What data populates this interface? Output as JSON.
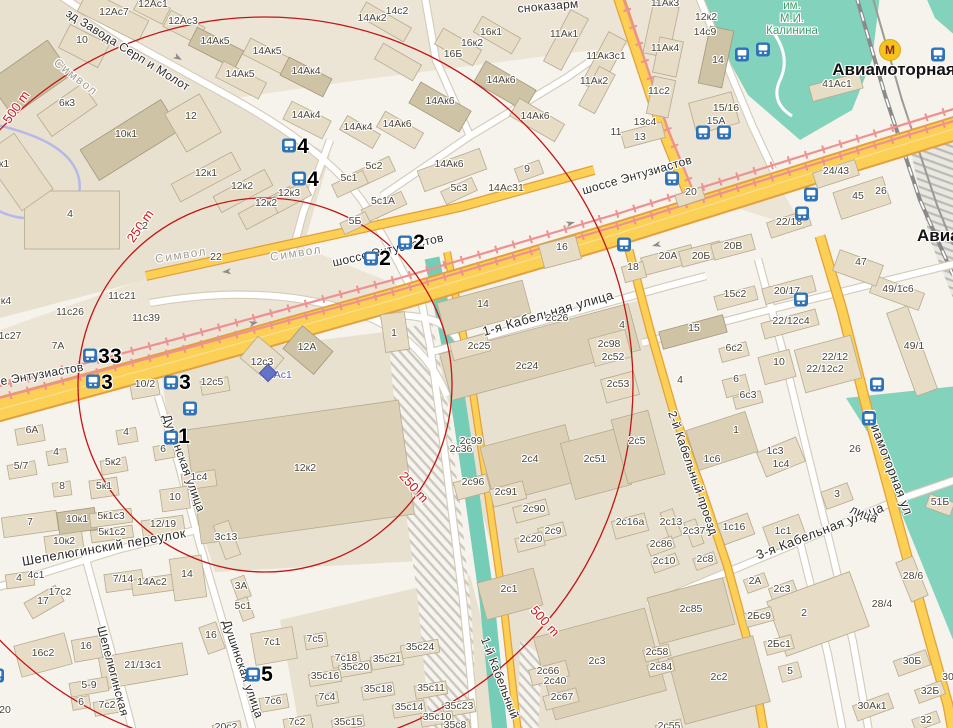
{
  "map": {
    "colors": {
      "ring": "#c41414",
      "road_major": "#fccf55",
      "tram": "#ee9191",
      "water": "#76cdb7",
      "park": "#82d2bc",
      "bus_icon": "#2e72b8",
      "metro_icon_bg": "#f5c31d",
      "street_label": "#2e2c28",
      "building_label": "#4a4539"
    },
    "rings": {
      "labels": [
        "250 m",
        "500 m"
      ]
    },
    "stations": [
      "Авиамоторная"
    ],
    "park_name": "им. М.И. Калинина",
    "labels": [
      [
        "зд Завода Серп и Молот",
        128,
        50,
        32,
        "s"
      ],
      [
        "Символ",
        76,
        77,
        38,
        "sg"
      ],
      [
        "Символ",
        181,
        255,
        -9,
        "sg"
      ],
      [
        "Символ",
        296,
        253,
        -9,
        "sg"
      ],
      [
        "сноказарм",
        548,
        6,
        -5,
        "s"
      ],
      [
        "е Энтузиастов",
        42,
        374,
        -10,
        "s"
      ],
      [
        "шоссе Энтузиастов",
        388,
        250,
        -13,
        "s"
      ],
      [
        "шоссе Энтузиастов",
        637,
        175,
        -16,
        "s"
      ],
      [
        "1-я Кабельная улица",
        548,
        313,
        -16,
        "s2"
      ],
      [
        "Шепелюгинский переулок",
        104,
        547,
        -10,
        "s2"
      ],
      [
        "Шепелюгинская",
        113,
        671,
        75,
        "s"
      ],
      [
        "Душинская улица",
        184,
        463,
        70,
        "s"
      ],
      [
        "Душинская улица",
        243,
        669,
        71,
        "s"
      ],
      [
        "1-й Кабельный",
        500,
        678,
        69,
        "s"
      ],
      [
        "2-й Кабельный проезд",
        693,
        473,
        71,
        "s"
      ],
      [
        "3-я Кабельная улица",
        820,
        531,
        -21,
        "s2"
      ],
      [
        "Авиамоторная ул",
        889,
        462,
        69,
        "s2"
      ],
      [
        "лица",
        864,
        514,
        22,
        "s"
      ],
      [
        "Авиамоторная",
        894,
        70,
        0,
        "st"
      ],
      [
        "Авиамоторная",
        917,
        236,
        0,
        "st",
        "l"
      ],
      [
        "им.\nМ.И.\nКалинина",
        792,
        19,
        0,
        "p"
      ],
      [
        "500 m",
        16,
        107,
        -55,
        "d"
      ],
      [
        "250 m",
        140,
        226,
        -55,
        "d"
      ],
      [
        "250 m",
        414,
        487,
        48,
        "d"
      ],
      [
        "500 m",
        545,
        621,
        48,
        "d"
      ],
      [
        "4",
        303,
        147,
        0,
        "n"
      ],
      [
        "4",
        313,
        180,
        0,
        "n"
      ],
      [
        "2",
        419,
        243,
        0,
        "n"
      ],
      [
        "2",
        385,
        259,
        0,
        "n"
      ],
      [
        "3",
        104,
        357,
        0,
        "n"
      ],
      [
        "3",
        116,
        357,
        0,
        "n"
      ],
      [
        "3",
        107,
        383,
        0,
        "n"
      ],
      [
        "3",
        185,
        383,
        0,
        "n"
      ],
      [
        "1",
        184,
        437,
        0,
        "n"
      ],
      [
        "5",
        267,
        675,
        0,
        "n"
      ],
      [
        "12Ас1",
        277,
        375,
        0,
        "bb"
      ],
      [
        "12Ас1",
        153,
        4
      ],
      [
        "12Ас7",
        114,
        12
      ],
      [
        "12Ас3",
        183,
        21
      ],
      [
        "10",
        82,
        40
      ],
      [
        "14Ак5",
        215,
        41
      ],
      [
        "14Ак5",
        267,
        51
      ],
      [
        "14Ак5",
        240,
        74
      ],
      [
        "14Ак4",
        306,
        71
      ],
      [
        "14Ак4",
        306,
        115
      ],
      [
        "14с2",
        397,
        11
      ],
      [
        "14Ак2",
        372,
        18
      ],
      [
        "16к1",
        491,
        32
      ],
      [
        "16к2",
        472,
        43
      ],
      [
        "16Б",
        453,
        54
      ],
      [
        "6к3",
        67,
        103
      ],
      [
        "12",
        191,
        116
      ],
      [
        "10к1",
        126,
        134
      ],
      [
        "14Ак6",
        501,
        80
      ],
      [
        "14Ак6",
        440,
        101
      ],
      [
        "14Ак6",
        397,
        124
      ],
      [
        "14Ак4",
        358,
        127
      ],
      [
        "14Ак6",
        535,
        116
      ],
      [
        "14Ак6",
        449,
        164
      ],
      [
        "12к1",
        206,
        173
      ],
      [
        "12к2",
        242,
        186
      ],
      [
        "12к3",
        289,
        193
      ],
      [
        "12к2",
        266,
        203
      ],
      [
        "4",
        70,
        214
      ],
      [
        "2",
        145,
        226
      ],
      [
        "к1",
        4,
        164
      ],
      [
        "22",
        216,
        257
      ],
      [
        "11с21",
        122,
        296
      ],
      [
        "11с26",
        70,
        312
      ],
      [
        "11с39",
        146,
        318
      ],
      [
        "1с27",
        10,
        336
      ],
      [
        "к4",
        6,
        301
      ],
      [
        "7А",
        58,
        346
      ],
      [
        "5с2",
        374,
        166
      ],
      [
        "5с1",
        349,
        178
      ],
      [
        "5с1А",
        383,
        201
      ],
      [
        "5Б",
        355,
        221
      ],
      [
        "5с3",
        459,
        188
      ],
      [
        "14Ас31",
        506,
        188
      ],
      [
        "9",
        527,
        169
      ],
      [
        "11Ак1",
        564,
        34
      ],
      [
        "11Ак3с1",
        606,
        56
      ],
      [
        "11Ак2",
        594,
        81
      ],
      [
        "11Ак3",
        665,
        3
      ],
      [
        "12к2",
        706,
        17
      ],
      [
        "14с9",
        705,
        32
      ],
      [
        "11Ак4",
        665,
        48
      ],
      [
        "14",
        718,
        60
      ],
      [
        "11с2",
        659,
        91
      ],
      [
        "13с4",
        645,
        122
      ],
      [
        "11",
        616,
        132
      ],
      [
        "13",
        640,
        137
      ],
      [
        "15/16",
        726,
        108
      ],
      [
        "15А",
        716,
        121
      ],
      [
        "41Ас1",
        837,
        84
      ],
      [
        "24/43",
        836,
        171
      ],
      [
        "45",
        858,
        196
      ],
      [
        "26",
        881,
        191
      ],
      [
        "47",
        861,
        262
      ],
      [
        "20",
        691,
        192
      ],
      [
        "22/18",
        789,
        222
      ],
      [
        "49/1с6",
        898,
        289
      ],
      [
        "49/1",
        914,
        346
      ],
      [
        "16",
        562,
        247
      ],
      [
        "18",
        633,
        267
      ],
      [
        "20А",
        668,
        256
      ],
      [
        "20Б",
        701,
        256
      ],
      [
        "20В",
        733,
        246
      ],
      [
        "15с2",
        735,
        294
      ],
      [
        "20/17",
        787,
        291
      ],
      [
        "22/12с4",
        791,
        321
      ],
      [
        "15",
        694,
        328
      ],
      [
        "6с2",
        734,
        348
      ],
      [
        "10",
        779,
        362
      ],
      [
        "22/12",
        835,
        357
      ],
      [
        "22/12с2",
        825,
        369
      ],
      [
        "4",
        680,
        380
      ],
      [
        "6",
        736,
        379
      ],
      [
        "6с3",
        748,
        395
      ],
      [
        "1",
        736,
        430
      ],
      [
        "5",
        641,
        441
      ],
      [
        "1с6",
        712,
        459
      ],
      [
        "1с3",
        775,
        451
      ],
      [
        "1с4",
        781,
        464
      ],
      [
        "26",
        855,
        449
      ],
      [
        "2с26",
        557,
        318
      ],
      [
        "14",
        483,
        304
      ],
      [
        "2с25",
        479,
        346
      ],
      [
        "2с24",
        527,
        366
      ],
      [
        "2с98",
        609,
        344
      ],
      [
        "2с52",
        613,
        357
      ],
      [
        "2с53",
        618,
        384
      ],
      [
        "4",
        622,
        325
      ],
      [
        "1",
        394,
        333
      ],
      [
        "12А",
        307,
        347
      ],
      [
        "12с3",
        262,
        362
      ],
      [
        "12с5",
        212,
        382
      ],
      [
        "10/2",
        145,
        384
      ],
      [
        "12к2",
        305,
        468
      ],
      [
        "1с4",
        199,
        477
      ],
      [
        "6А",
        32,
        430
      ],
      [
        "4",
        56,
        452
      ],
      [
        "5/7",
        21,
        466
      ],
      [
        "5к2",
        113,
        462
      ],
      [
        "4",
        126,
        432
      ],
      [
        "6",
        163,
        449
      ],
      [
        "2с99",
        471,
        441
      ],
      [
        "2с36",
        461,
        449
      ],
      [
        "2с4",
        530,
        459
      ],
      [
        "2с51",
        595,
        459
      ],
      [
        "2с5",
        637,
        441
      ],
      [
        "2с96",
        473,
        482
      ],
      [
        "2с91",
        506,
        492
      ],
      [
        "2с90",
        534,
        509
      ],
      [
        "2с9",
        553,
        531
      ],
      [
        "2с20",
        531,
        539
      ],
      [
        "2с16а",
        630,
        522
      ],
      [
        "2с1",
        509,
        589
      ],
      [
        "8",
        62,
        486
      ],
      [
        "5к1",
        104,
        486
      ],
      [
        "10",
        175,
        497
      ],
      [
        "7",
        30,
        522
      ],
      [
        "10к1",
        77,
        519
      ],
      [
        "5к1с3",
        111,
        516
      ],
      [
        "12/19",
        163,
        524
      ],
      [
        "10к2",
        64,
        541
      ],
      [
        "5к1с2",
        112,
        532
      ],
      [
        "3с13",
        226,
        537
      ],
      [
        "4",
        19,
        578
      ],
      [
        "4с1",
        36,
        575
      ],
      [
        "7/14",
        123,
        579
      ],
      [
        "14Ас2",
        152,
        582
      ],
      [
        "14",
        187,
        574
      ],
      [
        "17",
        43,
        601
      ],
      [
        "17с2",
        60,
        592
      ],
      [
        "3А",
        241,
        586
      ],
      [
        "5с1",
        243,
        606
      ],
      [
        "16",
        211,
        635
      ],
      [
        "16",
        86,
        646
      ],
      [
        "16с2",
        43,
        653
      ],
      [
        "7с1",
        272,
        642
      ],
      [
        "7с5",
        315,
        639
      ],
      [
        "21/13с1",
        143,
        665
      ],
      [
        "5-9",
        89,
        685
      ],
      [
        "6",
        81,
        702
      ],
      [
        "7с2",
        107,
        705
      ],
      [
        "20",
        5,
        710
      ],
      [
        "7с6",
        273,
        701
      ],
      [
        "7с2",
        297,
        722
      ],
      [
        "20с2",
        226,
        727
      ],
      [
        "35с24",
        420,
        647
      ],
      [
        "7с18",
        346,
        658
      ],
      [
        "35с21",
        387,
        659
      ],
      [
        "35с20",
        355,
        667
      ],
      [
        "35с16",
        325,
        676
      ],
      [
        "35с18",
        378,
        689
      ],
      [
        "35с11",
        431,
        688
      ],
      [
        "7с4",
        327,
        697
      ],
      [
        "35с14",
        409,
        707
      ],
      [
        "35с23",
        459,
        706
      ],
      [
        "35с15",
        348,
        722
      ],
      [
        "35с10",
        437,
        717
      ],
      [
        "35с8",
        455,
        725
      ],
      [
        "2с66",
        548,
        671
      ],
      [
        "2с40",
        555,
        681
      ],
      [
        "2с67",
        562,
        697
      ],
      [
        "2с3",
        597,
        661
      ],
      [
        "2с13",
        671,
        522
      ],
      [
        "2с37",
        694,
        531
      ],
      [
        "2с86",
        661,
        544
      ],
      [
        "2с10",
        664,
        561
      ],
      [
        "2с8",
        705,
        559
      ],
      [
        "1с16",
        734,
        527
      ],
      [
        "1с1",
        783,
        531
      ],
      [
        "3",
        837,
        494
      ],
      [
        "2А",
        755,
        581
      ],
      [
        "2с3",
        782,
        589
      ],
      [
        "2",
        804,
        613
      ],
      [
        "28/6",
        913,
        576
      ],
      [
        "28/4",
        882,
        604
      ],
      [
        "2с85",
        691,
        609
      ],
      [
        "2Бс9",
        759,
        616
      ],
      [
        "2Бс1",
        779,
        644
      ],
      [
        "5",
        790,
        671
      ],
      [
        "30Б",
        912,
        661
      ],
      [
        "32Б",
        930,
        691
      ],
      [
        "30Ак1",
        872,
        706
      ],
      [
        "32",
        926,
        720
      ],
      [
        "2с58",
        657,
        652
      ],
      [
        "2с84",
        661,
        667
      ],
      [
        "2с2",
        719,
        677
      ],
      [
        "2с55",
        669,
        726
      ],
      [
        "51Б",
        940,
        502
      ],
      [
        "30",
        948,
        677
      ]
    ],
    "icons": [
      [
        "bus",
        289,
        148
      ],
      [
        "bus",
        299,
        181
      ],
      [
        "bus",
        405,
        245
      ],
      [
        "bus",
        371,
        261
      ],
      [
        "bus",
        90,
        358
      ],
      [
        "bus",
        93,
        384
      ],
      [
        "bus",
        171,
        385
      ],
      [
        "bus",
        190,
        411
      ],
      [
        "bus",
        171,
        440
      ],
      [
        "bus",
        253,
        677
      ],
      [
        "bus",
        -3,
        678
      ],
      [
        "bus",
        742,
        57
      ],
      [
        "bus",
        763,
        52
      ],
      [
        "bus",
        938,
        57
      ],
      [
        "bus",
        703,
        135
      ],
      [
        "bus",
        724,
        135
      ],
      [
        "bus",
        672,
        181
      ],
      [
        "bus",
        811,
        197
      ],
      [
        "bus",
        802,
        216
      ],
      [
        "bus",
        801,
        302
      ],
      [
        "bus",
        877,
        387
      ],
      [
        "bus",
        869,
        421
      ],
      [
        "bus",
        624,
        247
      ],
      [
        "metro",
        890,
        50,
        "М"
      ],
      [
        "diamond",
        268,
        373
      ]
    ]
  }
}
